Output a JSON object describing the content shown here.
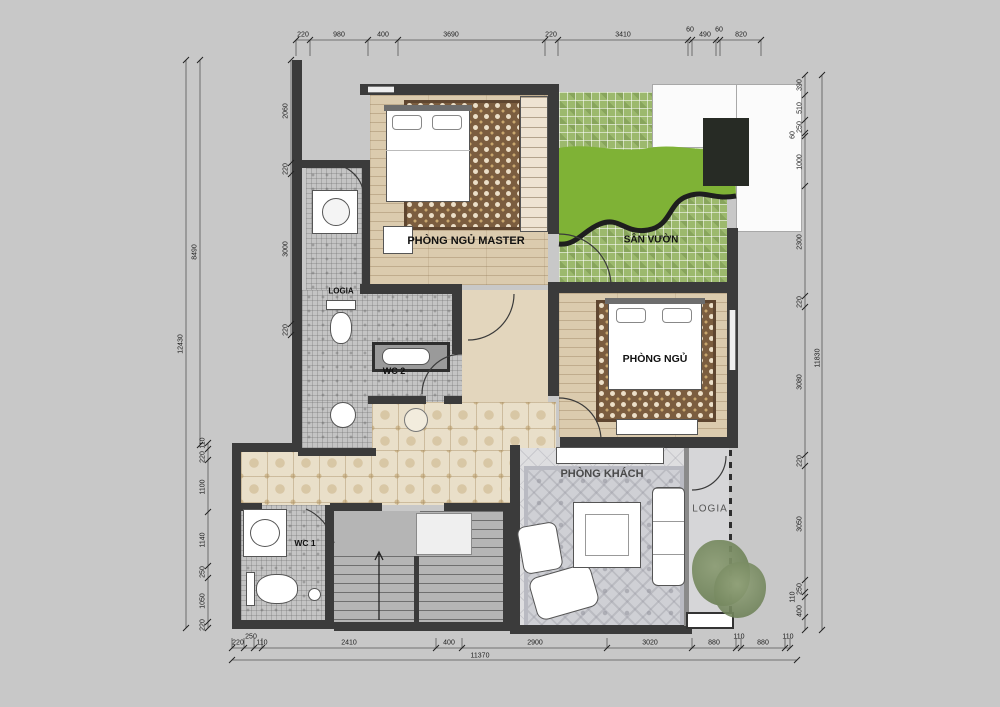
{
  "rooms": {
    "master_bedroom": "PHÒNG NGỦ MASTER",
    "garden": "SÂN VƯỜN",
    "bedroom": "PHÒNG NGỦ",
    "wc2": "WC 2",
    "wc1": "WC 1",
    "logia_left": "LOGIA",
    "logia_right": "LOGIA",
    "living_room": "PHÒNG KHÁCH"
  },
  "dims": {
    "top": [
      "220",
      "980",
      "400",
      "3690",
      "220",
      "3410",
      "60",
      "490",
      "60",
      "820"
    ],
    "bottom": [
      "220",
      "250",
      "110",
      "2410",
      "400",
      "2900",
      "3020",
      "880",
      "110",
      "880",
      "110"
    ],
    "bottom_total": "11370",
    "left_outer": "12430",
    "left_inner": "8490",
    "left_lower": [
      "110",
      "220",
      "1100",
      "1140",
      "250",
      "1050",
      "220"
    ],
    "left_upper": [
      "2060",
      "220",
      "3000",
      "220"
    ],
    "right": [
      "390",
      "510",
      "250",
      "60",
      "1000",
      "2300",
      "220",
      "3080",
      "220",
      "3050",
      "250",
      "110",
      "400"
    ],
    "right_total": "11830"
  },
  "colors": {
    "wall": "#3b3b3b",
    "wood_floor": "#dbcbae",
    "grass": "#7fb236",
    "garden_tile": "#9cb96d",
    "hall_tile": "#e9dfc9",
    "mosaic_tile": "#c4c4c4",
    "bedroom_carpet": "#7b5d3f",
    "living_carpet": "#cfd0d5",
    "background": "#c8c8c8"
  }
}
